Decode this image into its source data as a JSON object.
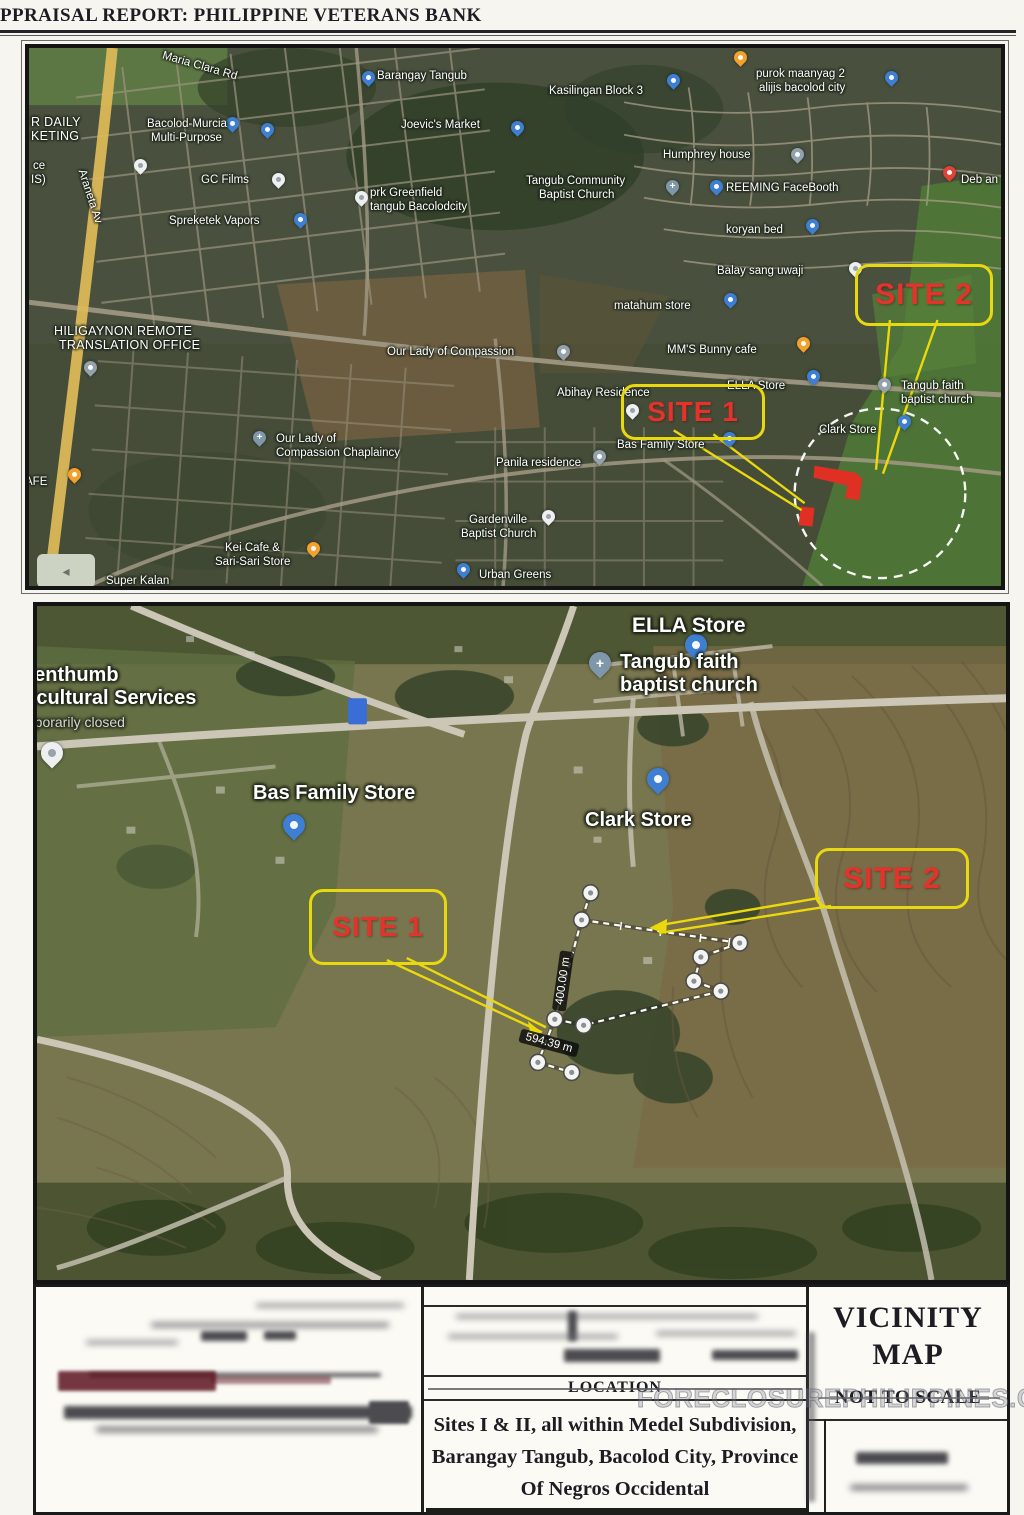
{
  "header": {
    "title": "PPRAISAL REPORT: PHILIPPINE VETERANS BANK"
  },
  "watermark": "FORECLOSUREPHILIPPINES.COM",
  "colors": {
    "site_red": "#e5322a",
    "callout_yellow": "#e8d80f",
    "site_shape_red": "#e02f23"
  },
  "map_top": {
    "site1": "SITE 1",
    "site2": "SITE 2",
    "labels": {
      "maria_clara_rd": "Maria Clara Rd",
      "araneta_ave": "Araneta Av",
      "super_daily_1": "R DAILY",
      "super_daily_2": "KETING",
      "partial_ce": "ce",
      "partial_is": "IS)",
      "partial_afe": "AFE",
      "bacolod_murcia_1": "Bacolod-Murcia",
      "bacolod_murcia_2": "Multi-Purpose",
      "barangay_tangub": "Barangay Tangub",
      "joevics_market": "Joevic's Market",
      "gc_films": "GC Films",
      "spreketek_vapors": "Spreketek Vapors",
      "prk_greenfield_1": "prk Greenfield",
      "prk_greenfield_2": "tangub Bacolodcity",
      "kasilingan_block": "Kasilingan Block 3",
      "purok_maanyag_1": "purok maanyag 2",
      "purok_maanyag_2": "alijis bacolod city",
      "humphrey_house": "Humphrey house",
      "tangub_community_1": "Tangub Community",
      "tangub_community_2": "Baptist Church",
      "reeming_facebooth": "REEMING FaceBooth",
      "koryan_bed": "koryan bed",
      "deb_an": "Deb an",
      "balay_sang": "Balay sang uwaji",
      "matahum_store": "matahum store",
      "hiligaynon_1": "HILIGAYNON REMOTE",
      "hiligaynon_2": "TRANSLATION OFFICE",
      "our_lady_compassion": "Our Lady of Compassion",
      "mms_bunny_cafe": "MM'S Bunny cafe",
      "abihay_residence": "Abihay Residence",
      "ella_store": "ELLA Store",
      "tangub_faith_1": "Tangub faith",
      "tangub_faith_2": "baptist church",
      "clark_store": "Clark Store",
      "our_lady_chaplaincy_1": "Our Lady of",
      "our_lady_chaplaincy_2": "Compassion Chaplaincy",
      "panila_residence": "Panila residence",
      "bas_family_store": "Bas Family Store",
      "gardenville_1": "Gardenville",
      "gardenville_2": "Baptist Church",
      "kei_cafe_1": "Kei Cafe &",
      "kei_cafe_2": "Sari-Sari Store",
      "super_kalan": "Super Kalan",
      "urban_greens": "Urban Greens"
    }
  },
  "map_bottom": {
    "site1": "SITE 1",
    "site2": "SITE 2",
    "labels": {
      "ella_store": "ELLA Store",
      "greenthumb_1": "eenthumb",
      "greenthumb_2": "ricultural Services",
      "greenthumb_3": "mporarily closed",
      "tangub_faith_1": "Tangub faith",
      "tangub_faith_2": "baptist church",
      "bas_family_store": "Bas Family Store",
      "clark_store": "Clark Store"
    },
    "measurements": {
      "side_vertical": "400.00 m",
      "side_diagonal": "594.39 m"
    }
  },
  "table": {
    "location_header": "LOCATION",
    "location_value": "Sites I & II, all within Medel Subdivision, Barangay Tangub, Bacolod City, Province Of Negros Occidental",
    "vicinity_title": "VICINITY MAP",
    "scale_note": "NOT TO SCALE"
  }
}
